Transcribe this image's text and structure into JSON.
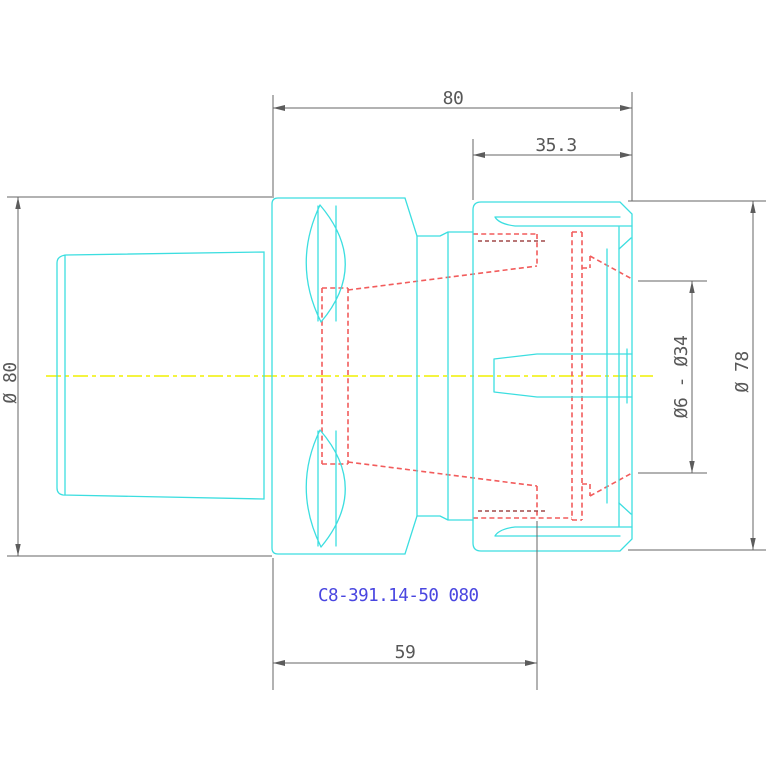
{
  "drawing": {
    "part_label": "C8-391.14-50 080",
    "dims": {
      "top": "80",
      "front": "35.3",
      "bottom": "59",
      "left": "Ø 80",
      "right": "Ø 78",
      "collet": "Ø6 - Ø34"
    },
    "colors": {
      "outline": "#3cdee0",
      "hidden": "#f25c5c",
      "hidden_dark": "#a04848",
      "centerline": "#f0f000",
      "dimension": "#666666",
      "label": "#4946e0",
      "background": "#ffffff"
    }
  }
}
